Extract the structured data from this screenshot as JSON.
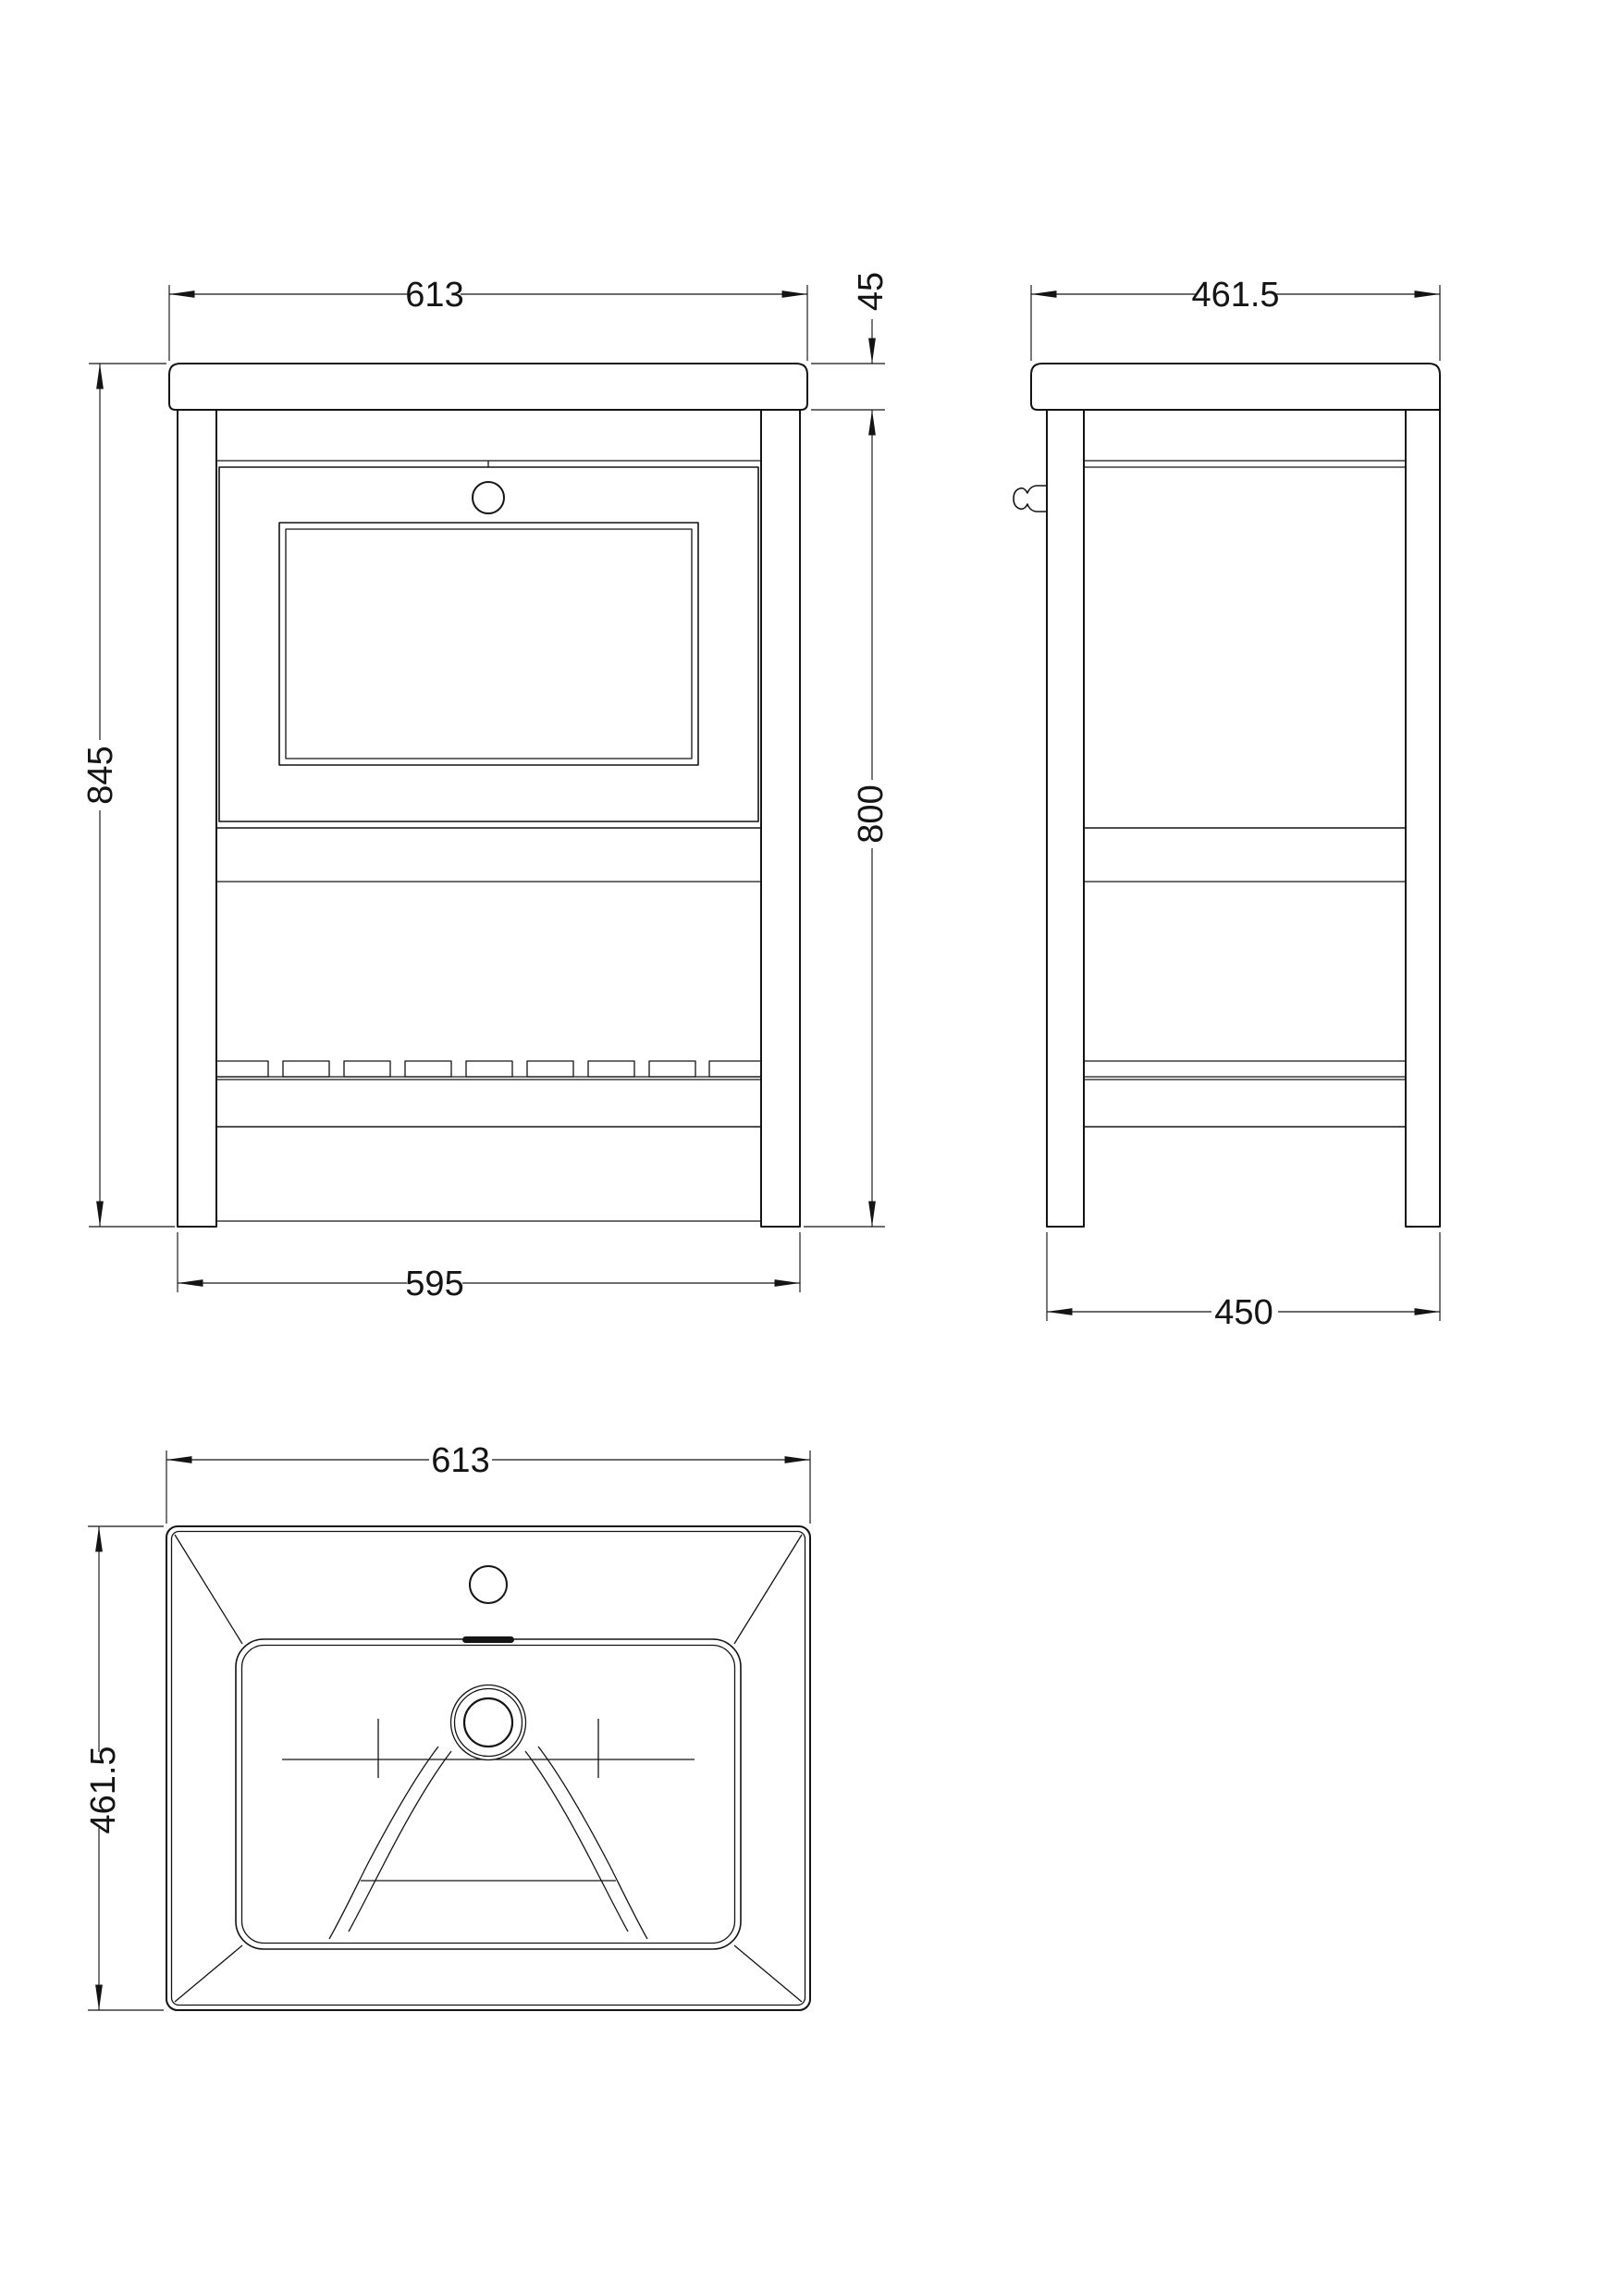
{
  "dimensions": {
    "front_view": {
      "top_width": "613",
      "top_thickness": "45",
      "total_height": "845",
      "cabinet_height": "800",
      "base_width": "595"
    },
    "side_view": {
      "top_depth": "461.5",
      "base_depth": "450"
    },
    "top_view": {
      "width": "613",
      "depth": "461.5"
    }
  }
}
